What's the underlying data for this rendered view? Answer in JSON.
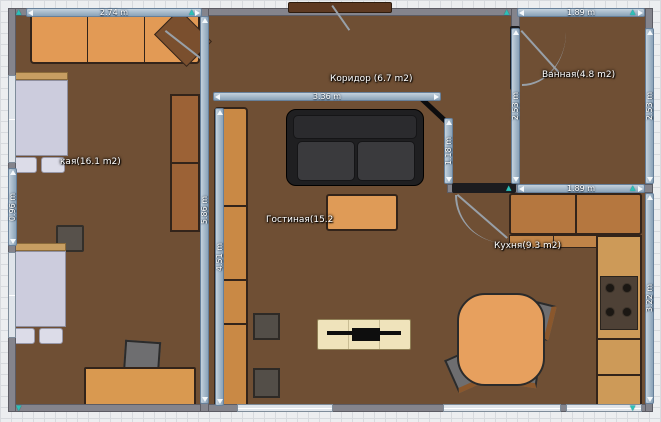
{
  "plan": {
    "rooms": {
      "bedroom": {
        "label": "кая(16.1 m2)"
      },
      "corridor": {
        "label": "Коридор (6.7 m2)"
      },
      "bathroom": {
        "label": "Ванная(4.8 m2)"
      },
      "living": {
        "label": "Гостиная(15.2"
      },
      "kitchen": {
        "label": "Кухня(9.3 m2)"
      }
    },
    "dimensions": {
      "bedroom_top_width": "2.74 m",
      "bathroom_top_width": "1.89 m",
      "corridor_width": "3.36 m",
      "bathroom_left_height": "2.53 m",
      "bathroom_right_height": "2.53 m",
      "hall_opening_height": "1.18 m",
      "left_wall_height": "5.86 m",
      "cabinet_length": "4.51 m",
      "bed_gap_height": "0.96 m",
      "kitchen_counter_width": "1.89 m",
      "kitchen_right_height": "3.22 m"
    },
    "icons": {
      "marker_up": "▲",
      "marker_down": "▼"
    },
    "colors": {
      "floor_wood": "#6f4f34",
      "wall": "#84848c",
      "dimension_bar": "#9db4c6",
      "furniture_orange": "#e09a55",
      "cabinet_brown": "#c98945",
      "sofa_black": "#242426",
      "bed_linen": "#cdcfe0",
      "tv_stand_cream": "#efe3bb",
      "dining_table": "#e7a05e",
      "endpoint_marker_teal": "#2ec0b8"
    }
  }
}
